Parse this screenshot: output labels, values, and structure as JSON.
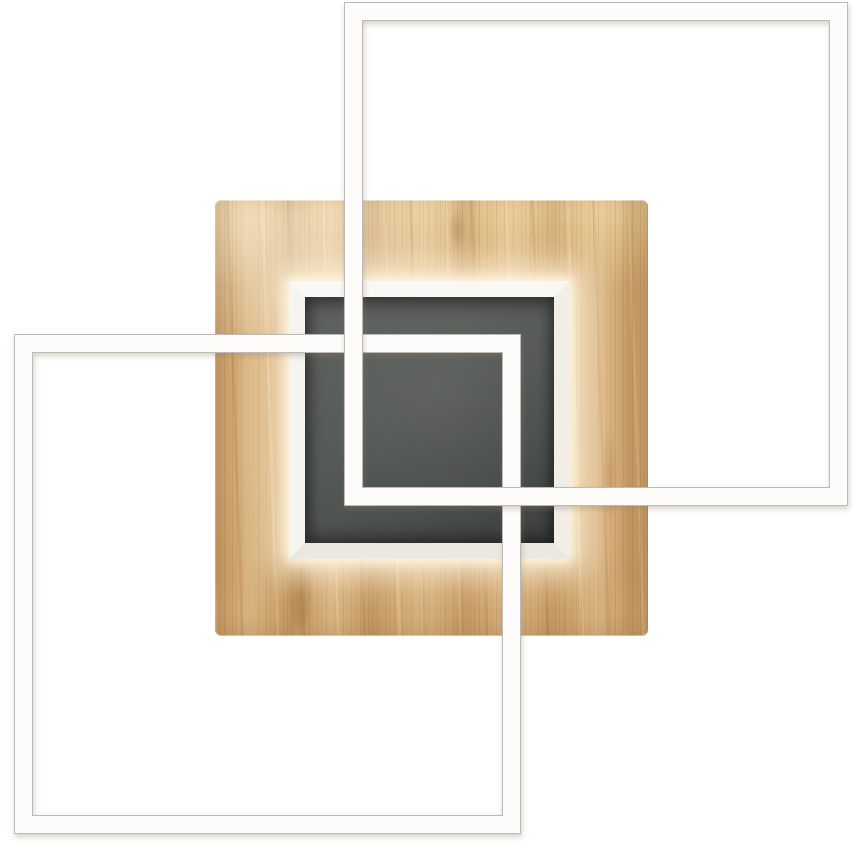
{
  "scene": {
    "kind": "product-photo",
    "subject": "Square LED ceiling lamp: oak wood base panel with recessed anthracite center and two overlapping white LED square frames",
    "elements": {
      "wood_panel": {
        "label": "oak wood square base panel",
        "x": 215,
        "y": 200,
        "w": 433,
        "h": 436
      },
      "recess_frame": {
        "label": "white mitred recess frame with warm LED glow",
        "x": 289,
        "y": 281,
        "w": 281,
        "h": 278,
        "border_px": 16
      },
      "center_panel": {
        "label": "anthracite recessed center square",
        "x": 305,
        "y": 297,
        "w": 249,
        "h": 246
      },
      "led_frame_top_right": {
        "label": "white LED square frame, upper right",
        "x": 345,
        "y": 3,
        "w": 502,
        "h": 502,
        "bar_px": 17
      },
      "led_frame_bottom_left": {
        "label": "white LED square frame, lower left",
        "x": 15,
        "y": 335,
        "w": 505,
        "h": 498,
        "bar_px": 17
      }
    }
  },
  "colors": {
    "background": "#ffffff",
    "wood_base": "#d2a873",
    "wood_light": "#e8cb98",
    "wood_shadow": "#b3854e",
    "recess_frame_white": "#faf8f4",
    "center_anthracite": "#575b59",
    "center_anthracite_dark": "#3b3f3d",
    "led_frame_white": "#fdfcfa",
    "frame_outline": "#bdbab5",
    "glow_warm": "#fff3db"
  }
}
